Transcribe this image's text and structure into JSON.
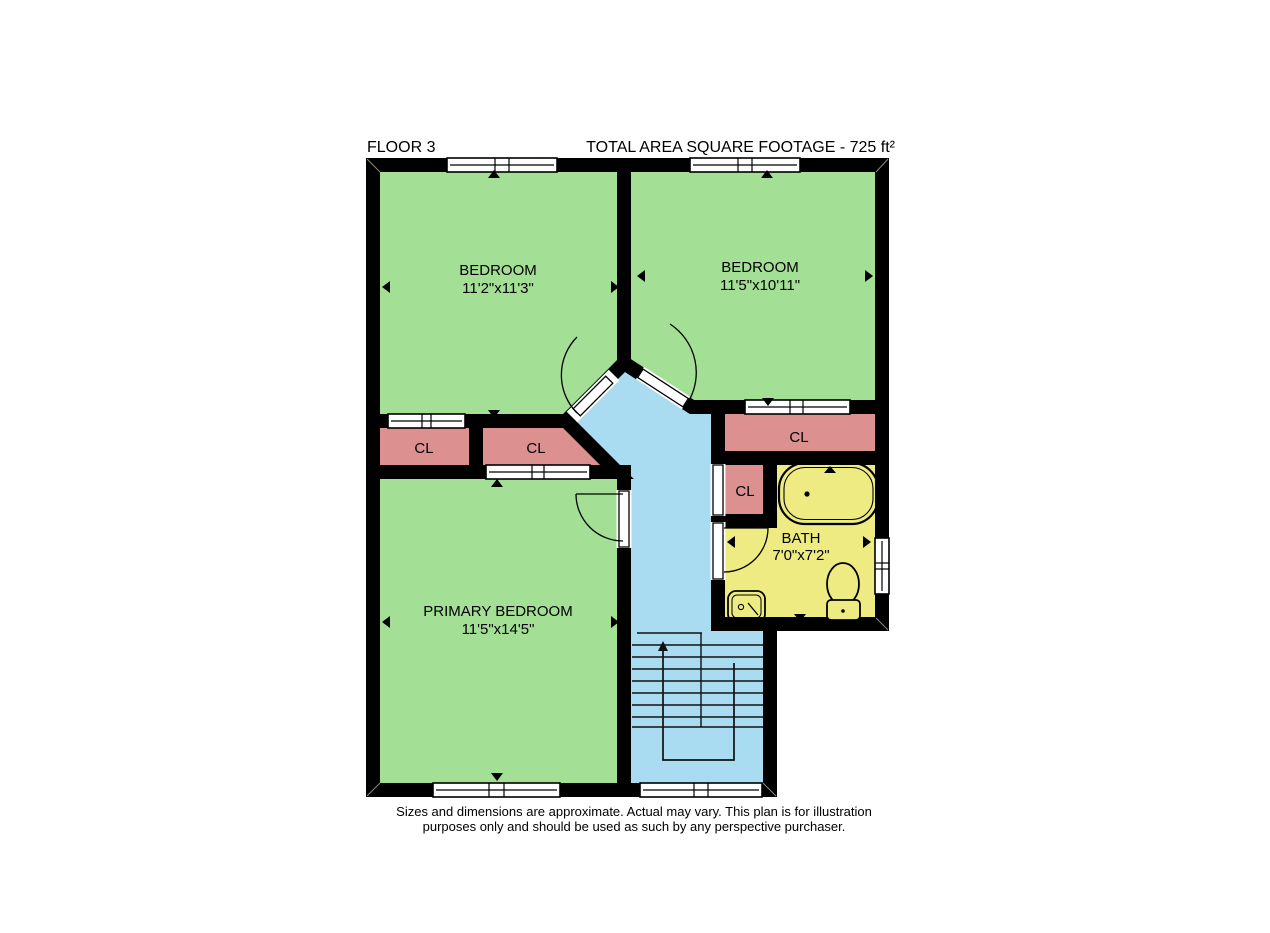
{
  "header": {
    "floor_label": "FLOOR 3",
    "total_area_label": "TOTAL AREA SQUARE FOOTAGE - 725 ft²"
  },
  "rooms": {
    "bedroom_left": {
      "name": "BEDROOM",
      "dims": "11'2\"x11'3\""
    },
    "bedroom_right": {
      "name": "BEDROOM",
      "dims": "11'5\"x10'11\""
    },
    "primary_bedroom": {
      "name": "PRIMARY BEDROOM",
      "dims": "11'5\"x14'5\""
    },
    "bath": {
      "name": "BATH",
      "dims": "7'0\"x7'2\""
    },
    "closet_left": {
      "name": "CL"
    },
    "closet_mid": {
      "name": "CL"
    },
    "closet_right": {
      "name": "CL"
    },
    "closet_bath": {
      "name": "CL"
    }
  },
  "footer": {
    "disclaimer_line1": "Sizes and dimensions are approximate. Actual may vary. This plan is for illustration",
    "disclaimer_line2": "purposes only and should be used as such by any perspective purchaser."
  },
  "colors": {
    "wall": "#000000",
    "bedroom": "#a3e095",
    "closet": "#dc9090",
    "bathroom": "#eeeb82",
    "hallway": "#aadcf1",
    "window": "#ffffff"
  }
}
